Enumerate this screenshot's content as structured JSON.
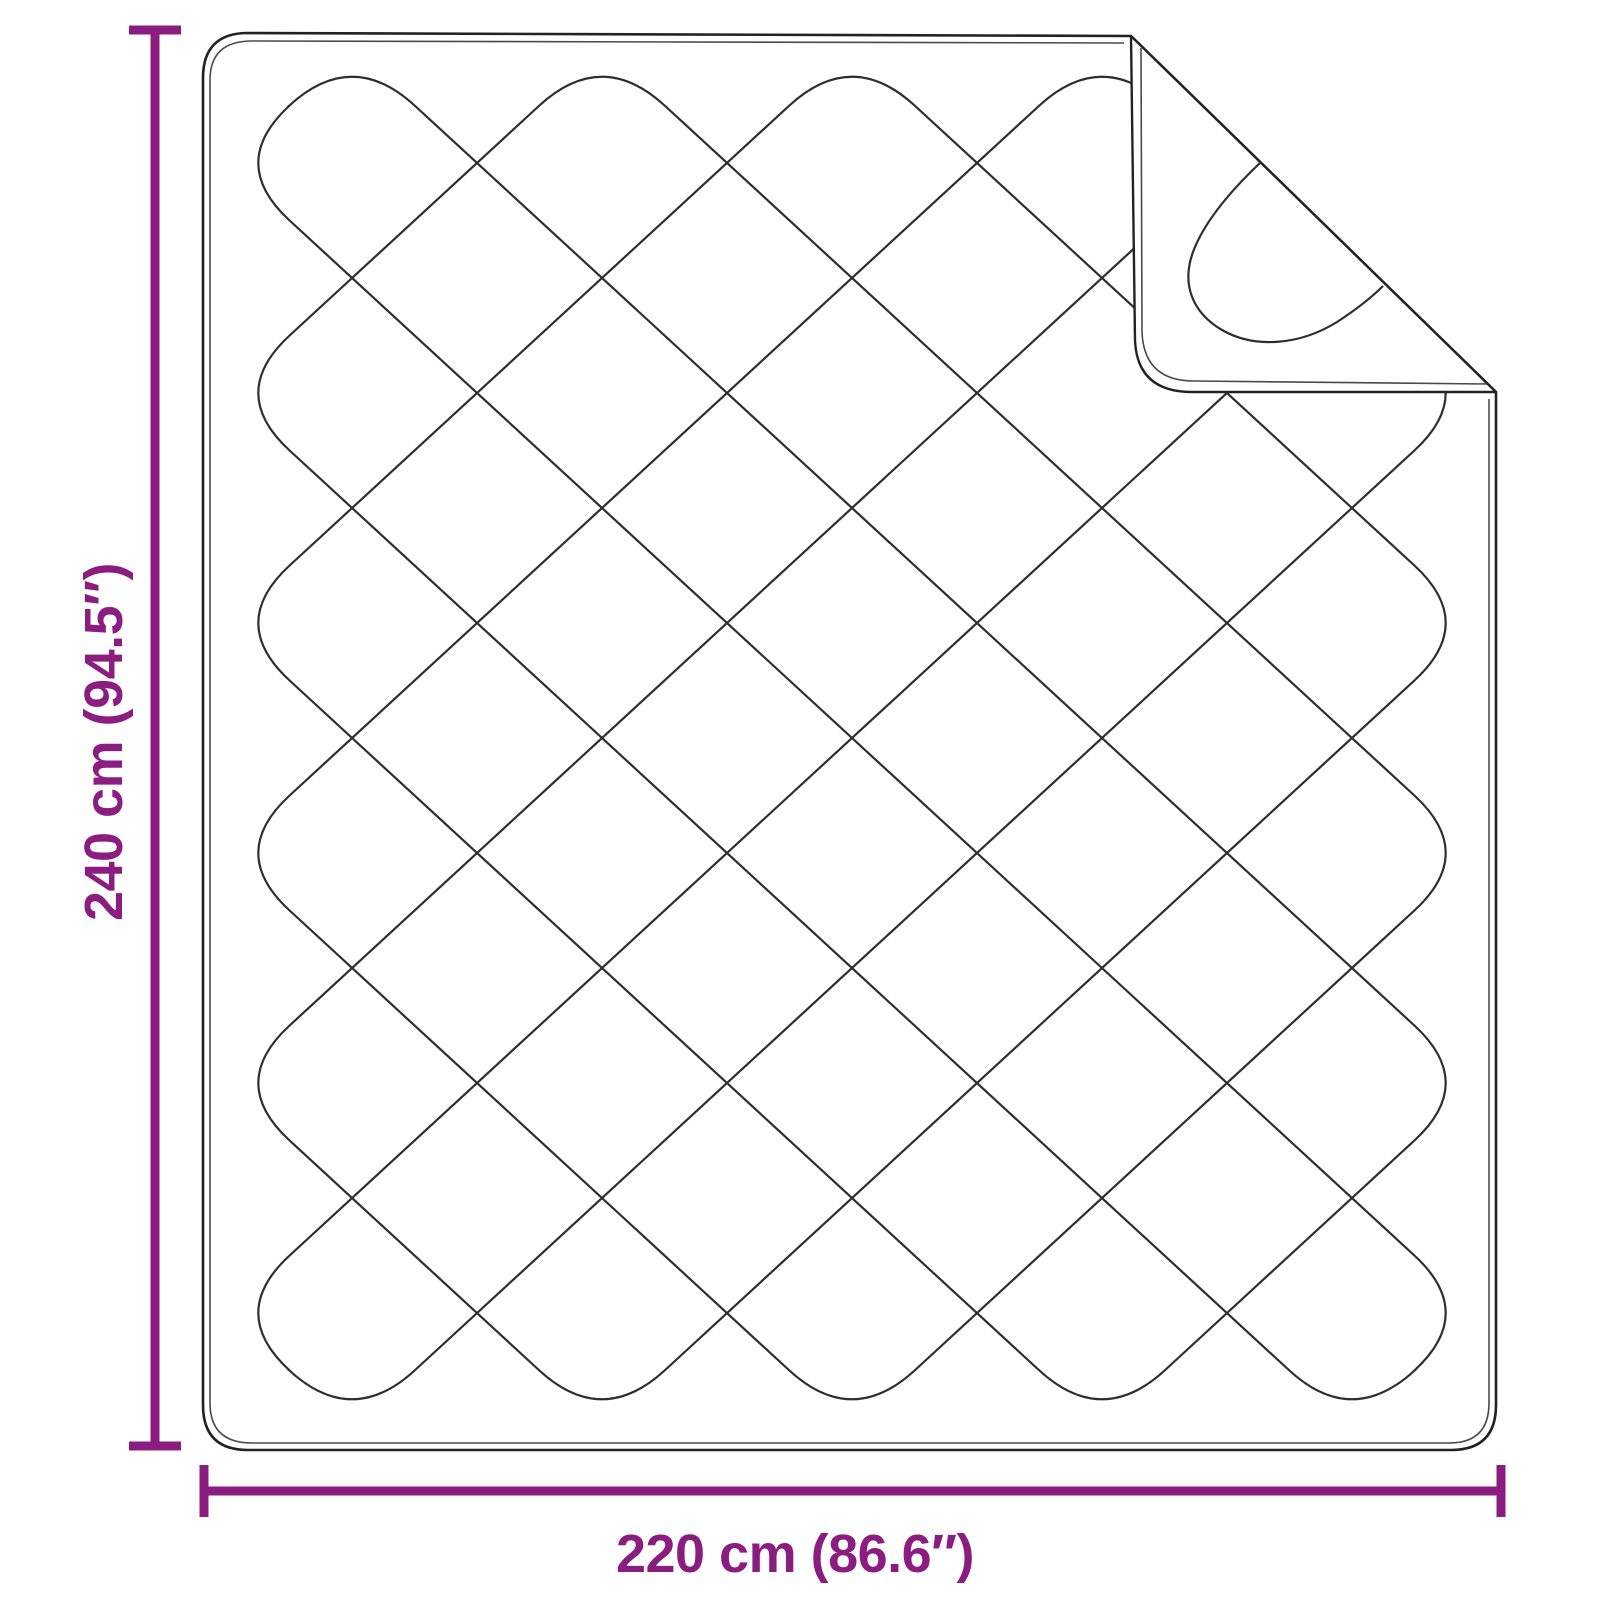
{
  "diagram": {
    "type": "product-dimension-diagram",
    "subject": "quilted blanket with folded corner",
    "height_label": "240 cm (94.5″)",
    "width_label": "220 cm (86.6″)"
  },
  "colors": {
    "dimension_accent": "#8B1D80",
    "line_color": "#2E2E2E",
    "background": "#FFFFFF"
  }
}
